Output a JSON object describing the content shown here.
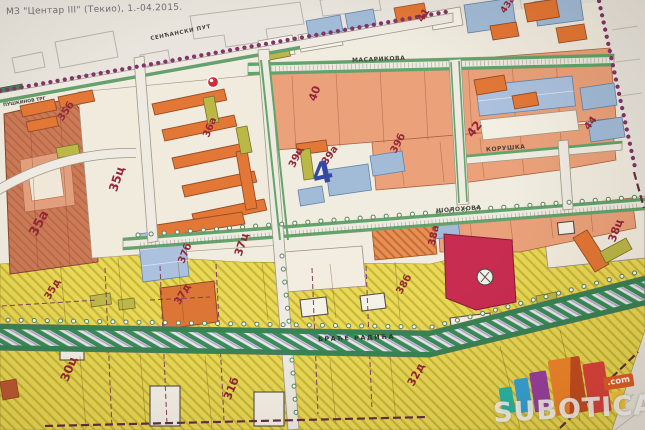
{
  "caption": "МЗ \"Центар III\" (Текио), 1.-04.2015.",
  "streets": {
    "sencanski": "СЕНЋАНСКИ ПУТ",
    "masarikova": "МАСАРИКОВА",
    "koruska": "КОРУШКА",
    "solohova": "ШОЛОХОВА",
    "brace_radica": "БРАЋЕ РАДИЋА",
    "puskinov_trg": "ПУШКИНОВ ТРГ"
  },
  "blocks": {
    "b30c": "30ц",
    "b31b": "31б",
    "b32d": "32д",
    "b35a": "35а",
    "b35b": "35б",
    "b35c": "35ц",
    "b35d": "35д",
    "b36a": "36а",
    "b37b": "37б",
    "b37c": "37ц",
    "b37d": "37д",
    "b38a": "38а",
    "b38b": "38б",
    "b38c": "38ц",
    "b39a": "39а",
    "b39b": "39б",
    "b39c": "39ц",
    "b40": "40",
    "b41": "41",
    "b42": "42",
    "b43a": "43а",
    "b44": "44"
  },
  "annotation": {
    "handwritten_mark": "4"
  },
  "logo": {
    "name": "SUBOTICA",
    "tld": ".com"
  },
  "colors": {
    "paper": "#e8e4dc",
    "terracotta_block": "#c9734e",
    "salmon_block": "#ea9d74",
    "blue_parcel": "#9db8d6",
    "yellow_zone": "#e7d74d",
    "orange_building": "#e2702c",
    "olive_building": "#b8b43f",
    "crimson_parcel": "#c62148",
    "road_green": "#2f8653",
    "boundary_purple": "#7c2a63",
    "block_label_red": "#8e1b2d",
    "handwritten_blue": "#2b3f9e"
  }
}
